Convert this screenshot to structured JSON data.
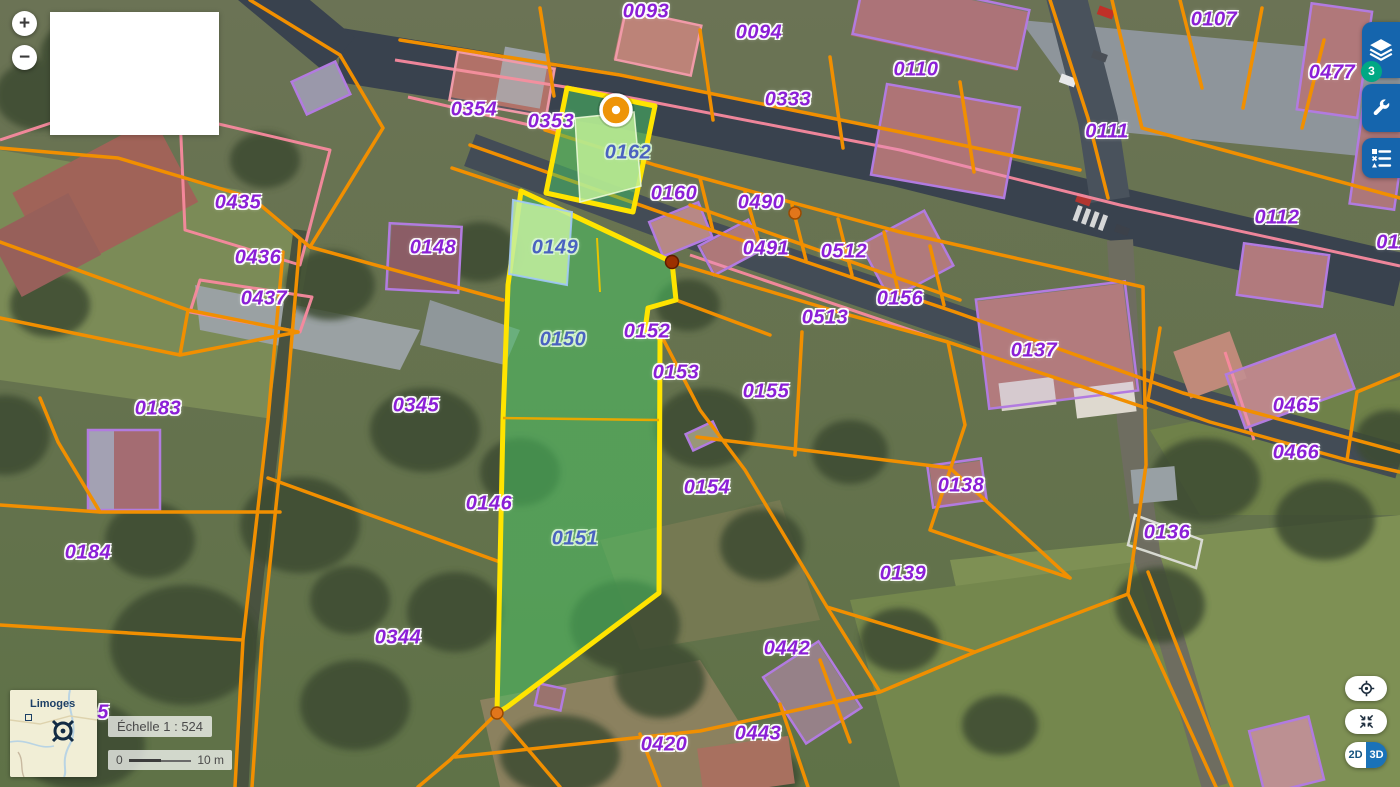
{
  "map": {
    "parcels": [
      {
        "id": "0093",
        "x": 646,
        "y": 12
      },
      {
        "id": "0094",
        "x": 759,
        "y": 33
      },
      {
        "id": "0110",
        "x": 916,
        "y": 70
      },
      {
        "id": "0333",
        "x": 788,
        "y": 100
      },
      {
        "id": "0107",
        "x": 1214,
        "y": 20
      },
      {
        "id": "0477",
        "x": 1332,
        "y": 73
      },
      {
        "id": "0111",
        "x": 1107,
        "y": 132
      },
      {
        "id": "0112",
        "x": 1277,
        "y": 218
      },
      {
        "id": "0354",
        "x": 474,
        "y": 110
      },
      {
        "id": "0353",
        "x": 551,
        "y": 122
      },
      {
        "id": "0162",
        "x": 628,
        "y": 153,
        "v": "in"
      },
      {
        "id": "0160",
        "x": 674,
        "y": 194
      },
      {
        "id": "0490",
        "x": 761,
        "y": 203
      },
      {
        "id": "0435",
        "x": 238,
        "y": 203
      },
      {
        "id": "0436",
        "x": 258,
        "y": 258
      },
      {
        "id": "0437",
        "x": 264,
        "y": 299
      },
      {
        "id": "0148",
        "x": 433,
        "y": 248
      },
      {
        "id": "0149",
        "x": 555,
        "y": 248,
        "v": "in"
      },
      {
        "id": "0491",
        "x": 766,
        "y": 249
      },
      {
        "id": "0512",
        "x": 844,
        "y": 252
      },
      {
        "id": "0156",
        "x": 900,
        "y": 299
      },
      {
        "id": "0513",
        "x": 825,
        "y": 318
      },
      {
        "id": "0137",
        "x": 1034,
        "y": 351
      },
      {
        "id": "0152",
        "x": 647,
        "y": 332
      },
      {
        "id": "0150",
        "x": 563,
        "y": 340,
        "v": "in"
      },
      {
        "id": "0153",
        "x": 676,
        "y": 373
      },
      {
        "id": "0155",
        "x": 766,
        "y": 392
      },
      {
        "id": "0183",
        "x": 158,
        "y": 409
      },
      {
        "id": "0345",
        "x": 416,
        "y": 406
      },
      {
        "id": "0465",
        "x": 1296,
        "y": 406
      },
      {
        "id": "0466",
        "x": 1296,
        "y": 453
      },
      {
        "id": "0184",
        "x": 88,
        "y": 553
      },
      {
        "id": "0146",
        "x": 489,
        "y": 504
      },
      {
        "id": "0151",
        "x": 575,
        "y": 539,
        "v": "in"
      },
      {
        "id": "0154",
        "x": 707,
        "y": 488
      },
      {
        "id": "0138",
        "x": 961,
        "y": 486
      },
      {
        "id": "0136",
        "x": 1167,
        "y": 533
      },
      {
        "id": "0139",
        "x": 903,
        "y": 574
      },
      {
        "id": "0344",
        "x": 398,
        "y": 638
      },
      {
        "id": "0442",
        "x": 787,
        "y": 649
      },
      {
        "id": "0443",
        "x": 758,
        "y": 734
      },
      {
        "id": "0420",
        "x": 664,
        "y": 745
      }
    ],
    "partial_labels": [
      {
        "text": "5",
        "x": 103,
        "y": 713
      },
      {
        "text": "011",
        "x": 1393,
        "y": 243
      }
    ],
    "colors": {
      "parcel_line": "#f18f00",
      "road_edge_pink": "#f8899e",
      "building_outline": "#b27be0",
      "label_purple": "#8b1fd6",
      "highlight_yellow": "#ffe400",
      "highlight_green_fill": "rgba(72,198,100,0.52)"
    }
  },
  "controls": {
    "zoom_in": "+",
    "zoom_out": "−",
    "layers_badge": "3",
    "toggle_2d": "2D",
    "toggle_3d": "3D"
  },
  "scale": {
    "label": "Échelle 1 : 524",
    "start": "0",
    "end": "10 m"
  },
  "minimap": {
    "place": "Limoges"
  },
  "icons": {
    "toolbar": [
      "layers-icon",
      "wrench-icon",
      "legend-list-icon"
    ],
    "bottom_right": [
      "locate-icon",
      "collapse-arrows-icon"
    ],
    "map": [
      "selected-point-marker",
      "vertex-dot"
    ]
  }
}
